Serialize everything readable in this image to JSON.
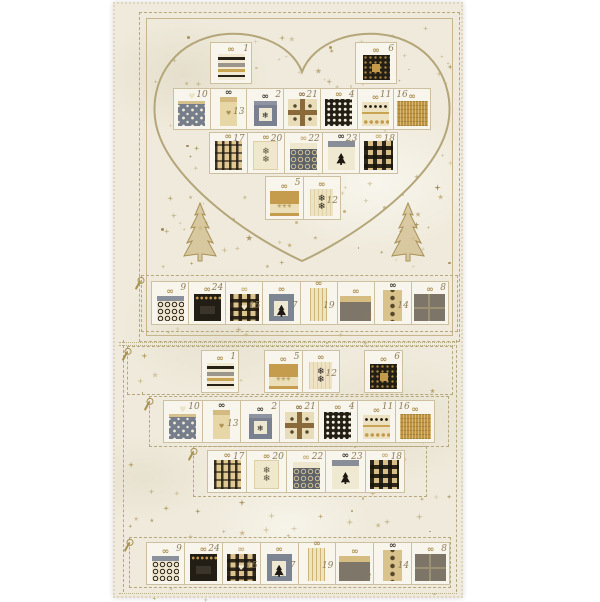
{
  "panel": {
    "kind": "christmas-advent-calendar-fabric-panel",
    "visible_text_numbers": [
      "1",
      "2",
      "3",
      "4",
      "5",
      "6",
      "7",
      "8",
      "9",
      "10",
      "11",
      "12",
      "13",
      "14",
      "15",
      "16",
      "17",
      "18",
      "19",
      "20",
      "21",
      "22",
      "23",
      "24"
    ]
  },
  "colors": {
    "page_bg": "#ffffff",
    "panel_bg": "#efeadb",
    "block_bg": "#f8f5ec",
    "block_border": "#ccc0a0",
    "stitch_dash": "#b5a77e",
    "frame_line": "#c6b68c",
    "number_text": "#8b7b58",
    "star_gold": "#a8924f",
    "heart_outline": "#b4a679",
    "tree_gold": "#b49c5e",
    "gift_black": "#241f15",
    "gift_gold": "#c59c4e",
    "gift_slate": "#7e8592",
    "gift_taupe": "#7c7568",
    "gift_cream": "#eee4c4",
    "gift_tan": "#d9c28c"
  },
  "icons": {
    "heart": "heart-outline-icon",
    "tree": "christmas-tree-icon",
    "star": "star-sparkle-icon",
    "pin": "needle-pin-icon",
    "bow": "ribbon-bow-icon"
  },
  "gifts": {
    "1": {
      "number": "1",
      "pattern": "cream-zigzag-bands",
      "bow": "gold"
    },
    "2": {
      "number": "2",
      "pattern": "slate-label-snowflake",
      "motif": "snowflake-black",
      "bow": "dark"
    },
    "3": {
      "number": "3",
      "pattern": "taupe-tan-lid",
      "bow": "gold",
      "number_pos": "bottom"
    },
    "4": {
      "number": "4",
      "pattern": "black-white-grid",
      "bow": "gold"
    },
    "5": {
      "number": "5",
      "pattern": "gold-snowflake-band",
      "motif": "snowflake-gold-3",
      "bow": "gold"
    },
    "6": {
      "number": "6",
      "pattern": "black-gold-dots-square",
      "bow": "gold"
    },
    "7": {
      "number": "7",
      "pattern": "slate-tree-label",
      "motif": "tree",
      "bow": "gold",
      "number_pos": "middle"
    },
    "8": {
      "number": "8",
      "pattern": "taupe-ribbon-cross",
      "bow": "gold"
    },
    "9": {
      "number": "9",
      "pattern": "cream-swirls-slate-lid",
      "bow": "gold"
    },
    "10": {
      "number": "10",
      "pattern": "slate-white-stars",
      "bow": "heart"
    },
    "11": {
      "number": "11",
      "pattern": "cream-dot-rows",
      "bow": "gold"
    },
    "12": {
      "number": "12",
      "pattern": "cream-two-black-snowflakes",
      "motif": "snowflake-black-2",
      "bow": "gold",
      "number_pos": "middle"
    },
    "13": {
      "number": "13",
      "pattern": "tan-tall-heart",
      "motif": "heart-gold",
      "bow": "dark",
      "number_pos": "middle"
    },
    "14": {
      "number": "14",
      "pattern": "tan-ornament-column",
      "bow": "dark",
      "number_pos": "middle"
    },
    "15": {
      "number": "15",
      "pattern": "buffalo-plaid-heart",
      "motif": "heart-cream",
      "bow": "tan",
      "number_pos": "middle"
    },
    "16": {
      "number": "16",
      "pattern": "gold-weave",
      "bow": "gold",
      "number_pos": "left"
    },
    "17": {
      "number": "17",
      "pattern": "tan-black-tartan",
      "bow": "gold"
    },
    "18": {
      "number": "18",
      "pattern": "buffalo-check",
      "bow": "tan"
    },
    "19": {
      "number": "19",
      "pattern": "cream-stripes-tall",
      "bow": "gold",
      "number_pos": "middle"
    },
    "20": {
      "number": "20",
      "pattern": "cream-two-dark-snowflakes",
      "motif": "snowflake-dark-2",
      "bow": "gold"
    },
    "21": {
      "number": "21",
      "pattern": "cream-ribbon-cross-snow",
      "bow": "brown"
    },
    "22": {
      "number": "22",
      "pattern": "dark-swirls-cream-lid",
      "bow": "tan"
    },
    "23": {
      "number": "23",
      "pattern": "cream-slate-lid-tree",
      "motif": "tree",
      "bow": "dark"
    },
    "24": {
      "number": "24",
      "pattern": "black-gold-dot-lid",
      "bow": "gold"
    }
  },
  "sections": {
    "heart_block": {
      "top_left": [
        "1"
      ],
      "top_right": [
        "6"
      ],
      "row2": [
        "10",
        "13",
        "2",
        "21",
        "4",
        "11",
        "16"
      ],
      "row3": [
        "17",
        "20",
        "22",
        "23",
        "18"
      ],
      "bottom_pair": [
        "5",
        "12"
      ]
    },
    "cutting_strip": [
      "9",
      "24",
      "15",
      "7",
      "19",
      "3",
      "14",
      "8"
    ],
    "lower_rows": {
      "row_a": [
        [
          "1"
        ],
        [
          "5",
          "12"
        ],
        [
          "6"
        ]
      ],
      "row_b": [
        "10",
        "13",
        "2",
        "21",
        "4",
        "11",
        "16"
      ],
      "row_c": [
        "17",
        "20",
        "22",
        "23",
        "18"
      ],
      "row_d": [
        "9",
        "24",
        "15",
        "7",
        "19",
        "3",
        "14",
        "8"
      ]
    }
  }
}
